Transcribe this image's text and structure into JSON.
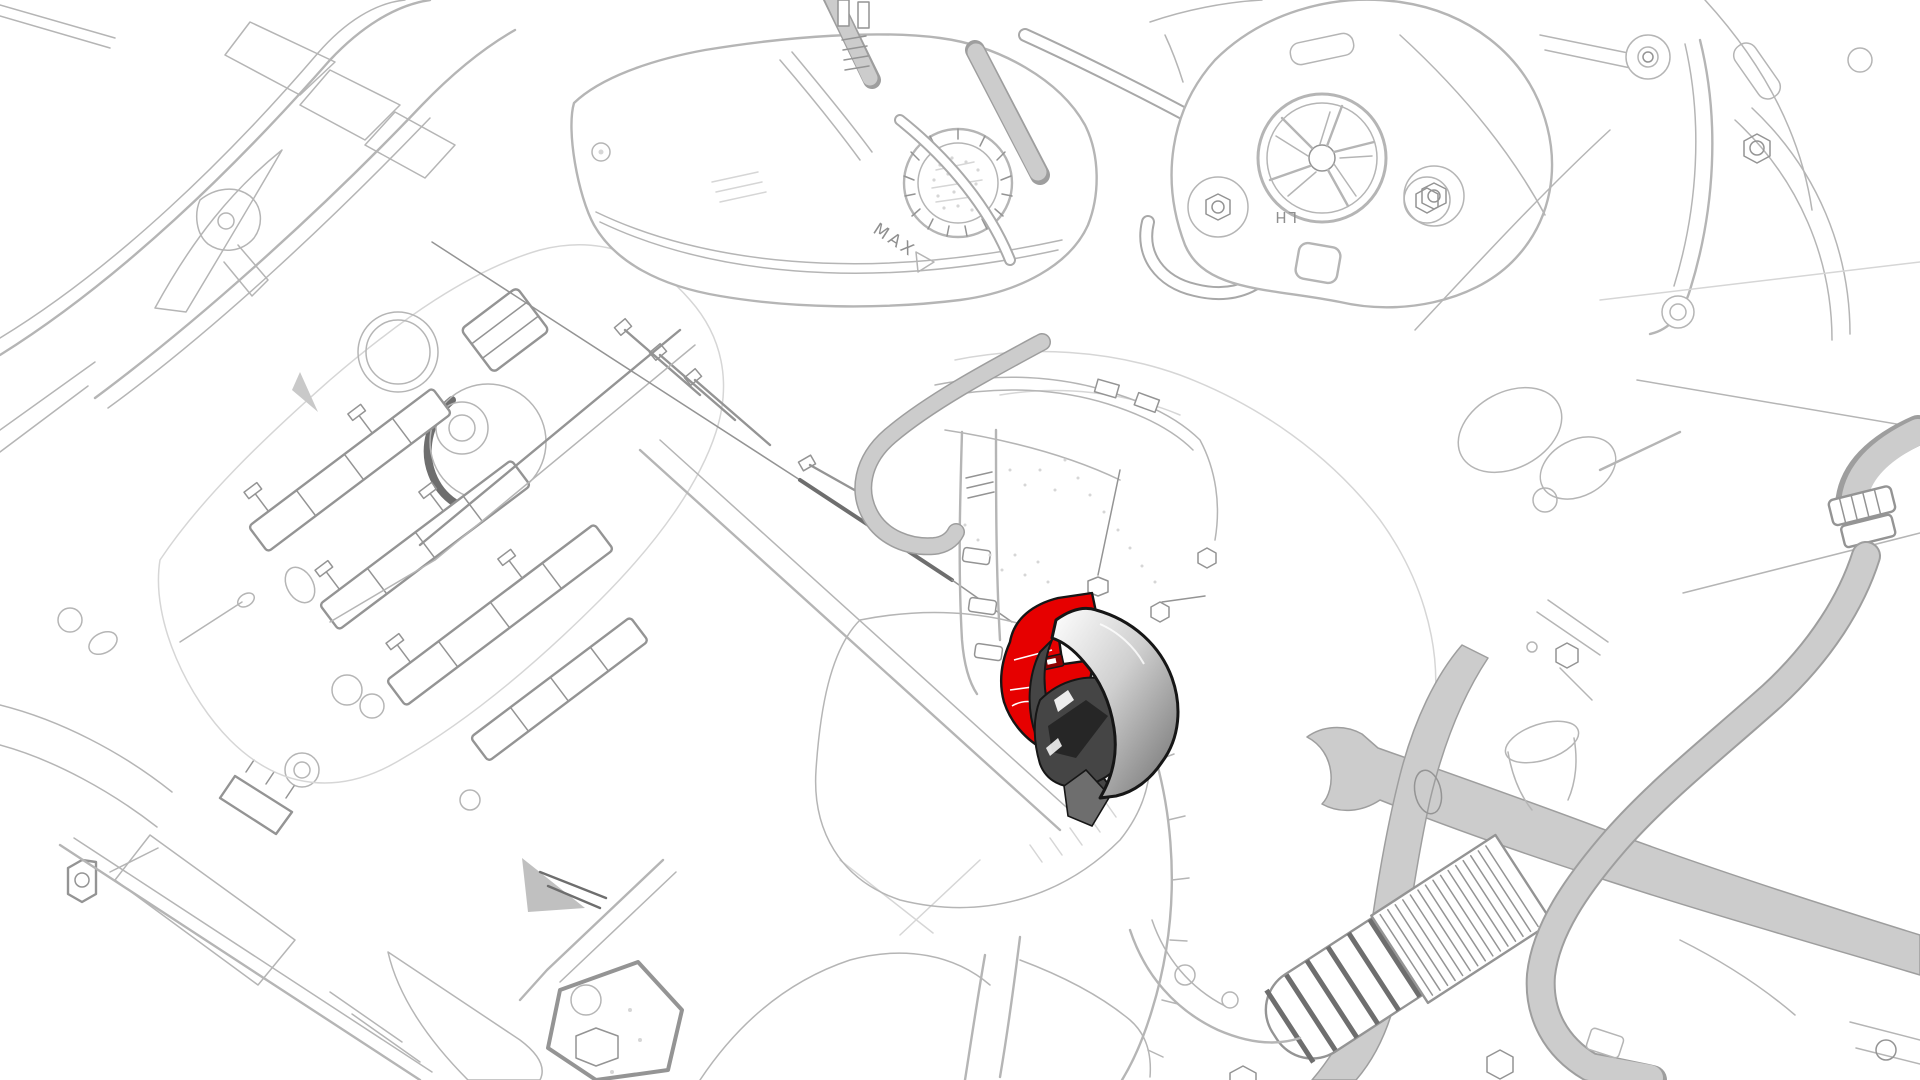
{
  "page": {
    "title": "Front compartment component illustration",
    "background": "#ffffff"
  },
  "illustration": {
    "kind": "monochrome technical line drawing of an engine bay, one component highlighted in red with a shaded cover",
    "labels": {
      "reservoir_max": "MAX",
      "bracket_lh": "LH"
    },
    "highlighted_component": {
      "fill": "#e60000",
      "outline": "#161616",
      "shield_gradient_start": "#ffffff",
      "shield_gradient_end": "#6f6f6f"
    },
    "colors": {
      "background": "#ffffff",
      "line_xlight": "#d6d6d6",
      "line_light": "#b5b5b5",
      "line_mid": "#949494",
      "line_dark": "#6e6e6e",
      "harness_fill": "#cccccc",
      "harness_edge": "#9e9e9e",
      "highlight_red": "#e60000",
      "highlight_dark_red": "#8f0000",
      "outline_black": "#161616",
      "part_dark": "#454545",
      "part_darker": "#262626",
      "part_mid": "#6e6e6e",
      "shield_light": "#ffffff",
      "shield_dark": "#6f6f6f",
      "text_gray": "#8f8f8f"
    }
  }
}
